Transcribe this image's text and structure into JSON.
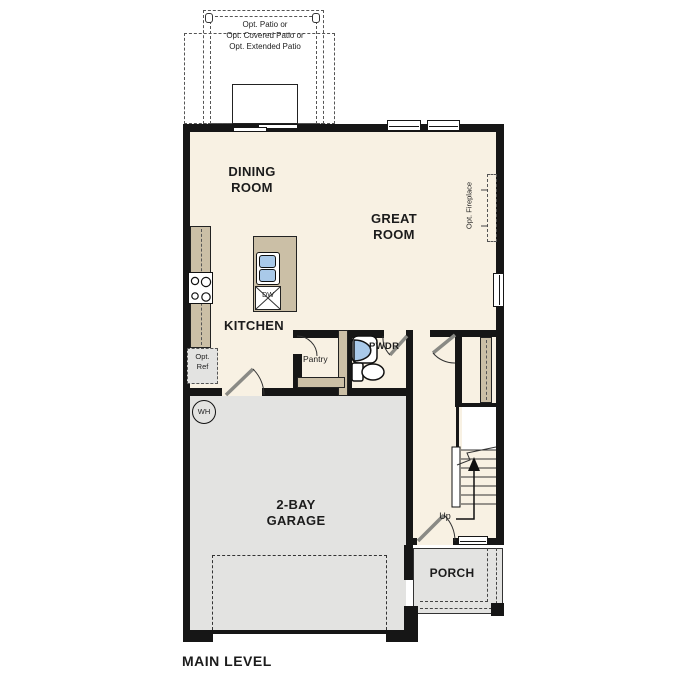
{
  "plan": {
    "title": "MAIN LEVEL",
    "colors": {
      "floor": "#F8F1E3",
      "cabinet": "#CBBFA6",
      "concrete": "#E3E3E1",
      "fixture_blue": "#A9C9E9",
      "wall": "#161616"
    },
    "patio": {
      "line1": "Opt. Patio or",
      "line2": "Opt. Covered Patio or",
      "line3": "Opt. Extended Patio"
    },
    "rooms": {
      "dining_line1": "DINING",
      "dining_line2": "ROOM",
      "great_line1": "GREAT",
      "great_line2": "ROOM",
      "kitchen": "KITCHEN",
      "pantry": "Pantry",
      "powder": "PWDR",
      "garage_line1": "2-BAY",
      "garage_line2": "GARAGE",
      "porch": "PORCH"
    },
    "annotations": {
      "opt_ref_line1": "Opt.",
      "opt_ref_line2": "Ref",
      "opt_fireplace": "Opt. Fireplace",
      "dishwasher": "DW",
      "water_heater": "WH",
      "up": "Up"
    }
  }
}
